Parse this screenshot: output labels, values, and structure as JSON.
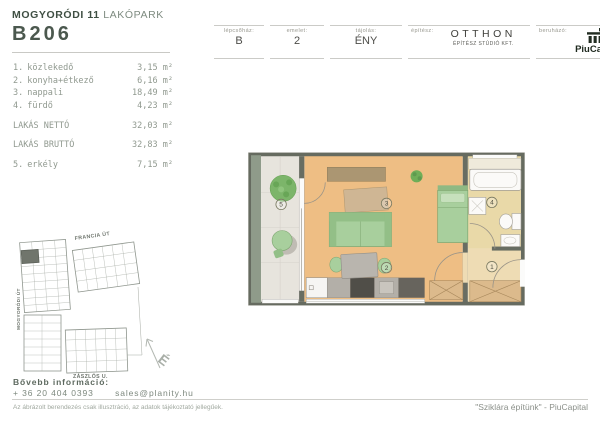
{
  "header": {
    "project_name": "MOGYORÓDI 11",
    "project_suffix": " LAKÓPARK",
    "unit_id": "B206",
    "meta": [
      {
        "label": "lépcsőház:",
        "value": "B"
      },
      {
        "label": "emelet:",
        "value": "2"
      },
      {
        "label": "tájolás:",
        "value": "ÉNY"
      }
    ],
    "architect": {
      "label": "építész:",
      "name": "OTTHON",
      "subtitle": "ÉPÍTÉSZ STÚDIÓ KFT."
    },
    "developer": {
      "label": "beruházó:",
      "name": "PiuCapital"
    }
  },
  "rooms": {
    "items": [
      {
        "num": "1.",
        "name": "közlekedő",
        "area": "3,15 m²"
      },
      {
        "num": "2.",
        "name": "konyha+étkező",
        "area": "6,16 m²"
      },
      {
        "num": "3.",
        "name": "nappali",
        "area": "18,49 m²"
      },
      {
        "num": "4.",
        "name": "fürdő",
        "area": "4,23 m²"
      }
    ],
    "net": {
      "label": "LAKÁS NETTÓ",
      "area": "32,03 m²"
    },
    "gross": {
      "label": "LAKÁS BRUTTÓ",
      "area": "32,83 m²"
    },
    "balcony": {
      "num": "5.",
      "name": "erkély",
      "area": "7,15 m²"
    }
  },
  "floor_plan": {
    "labels": {
      "hall": "1",
      "kitchen": "2",
      "living": "3",
      "bath": "4",
      "balcony": "5"
    }
  },
  "site_plan": {
    "street_top": "FRANCIA ÚT",
    "street_left": "MOGYORÓDI ÚT",
    "street_bottom": "ZÁSZLÓS U.",
    "north": "É"
  },
  "footer": {
    "info_label": "Bővebb információ:",
    "phone": "+ 36 20 404 0393",
    "email": "sales@planity.hu",
    "disclaimer": "Az ábrázolt berendezés csak illusztráció, az adatok tájékoztató jellegűek.",
    "slogan": "\"Sziklára építünk\" - PiuCapital"
  },
  "colors": {
    "accent_dark": "#3f4f43",
    "text_muted": "#90998f",
    "floor_tan": "#eebe84",
    "balcony_floor": "#e7e4dd",
    "bathroom_floor": "#e9d9a8",
    "furniture_green": "#a8cf9d",
    "wall_dark": "#686d62",
    "balcony_wall_green": "#8f9b8a",
    "logo_dark": "#222d22"
  }
}
